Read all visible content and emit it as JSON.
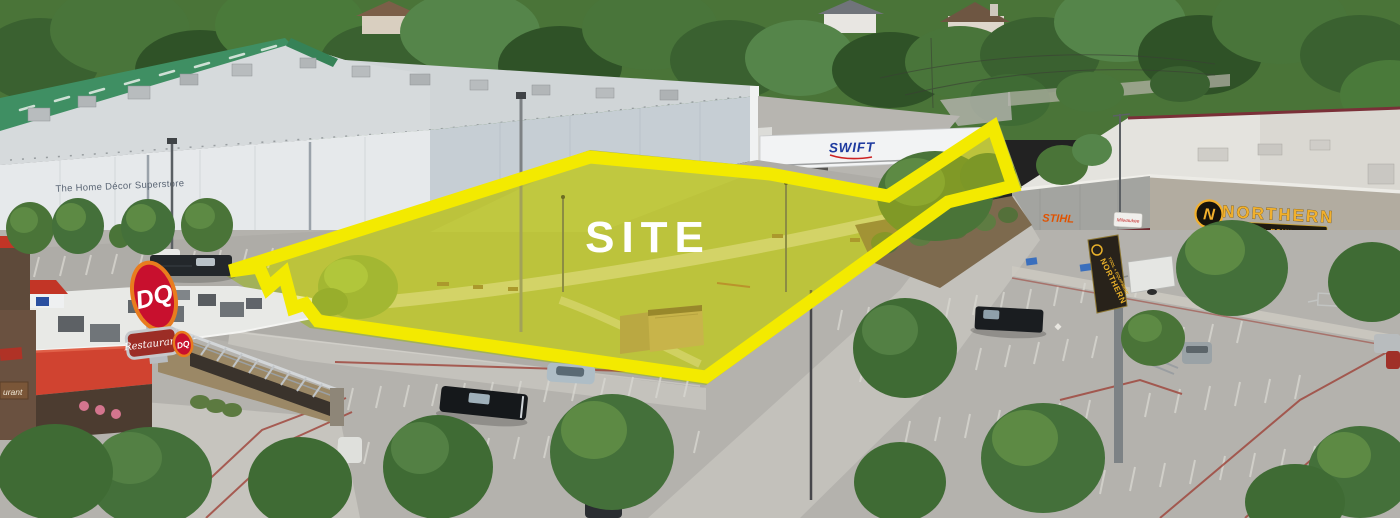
{
  "site": {
    "label": "SITE"
  },
  "signs": {
    "home_decor": "The Home Décor  Superstore",
    "swift": "SWIFT",
    "northern_name": "NORTHERN",
    "northern_tagline": "TOOL + EQUIPMENT",
    "northern_logo_letter": "N",
    "northern_pylon_name": "NORTHERN",
    "northern_pylon_tagline": "TOOL + EQUIPMENT",
    "stihl": "STIHL",
    "milwaukee": "Milwaukee",
    "dq_pylon": "DQ",
    "dq_badge": "DQ",
    "dq_restaurant": "Restaurant",
    "dq_restaurant_partial": "urant"
  },
  "colors": {
    "site_outline": "#F3EA00",
    "site_fill_tint": "rgba(244,234,0,0.32)",
    "site_text": "#FFFFFF",
    "grass": "#A2B159",
    "asphalt": "#B4B2AD",
    "tree_green": "#4A7438",
    "green_roof_strip": "#3F8F63",
    "northern_gold": "#F2B02C",
    "stihl_orange": "#E05200",
    "swift_blue": "#1E3A9F",
    "dq_red": "#C8102E",
    "maroon": "#6E2A30"
  }
}
